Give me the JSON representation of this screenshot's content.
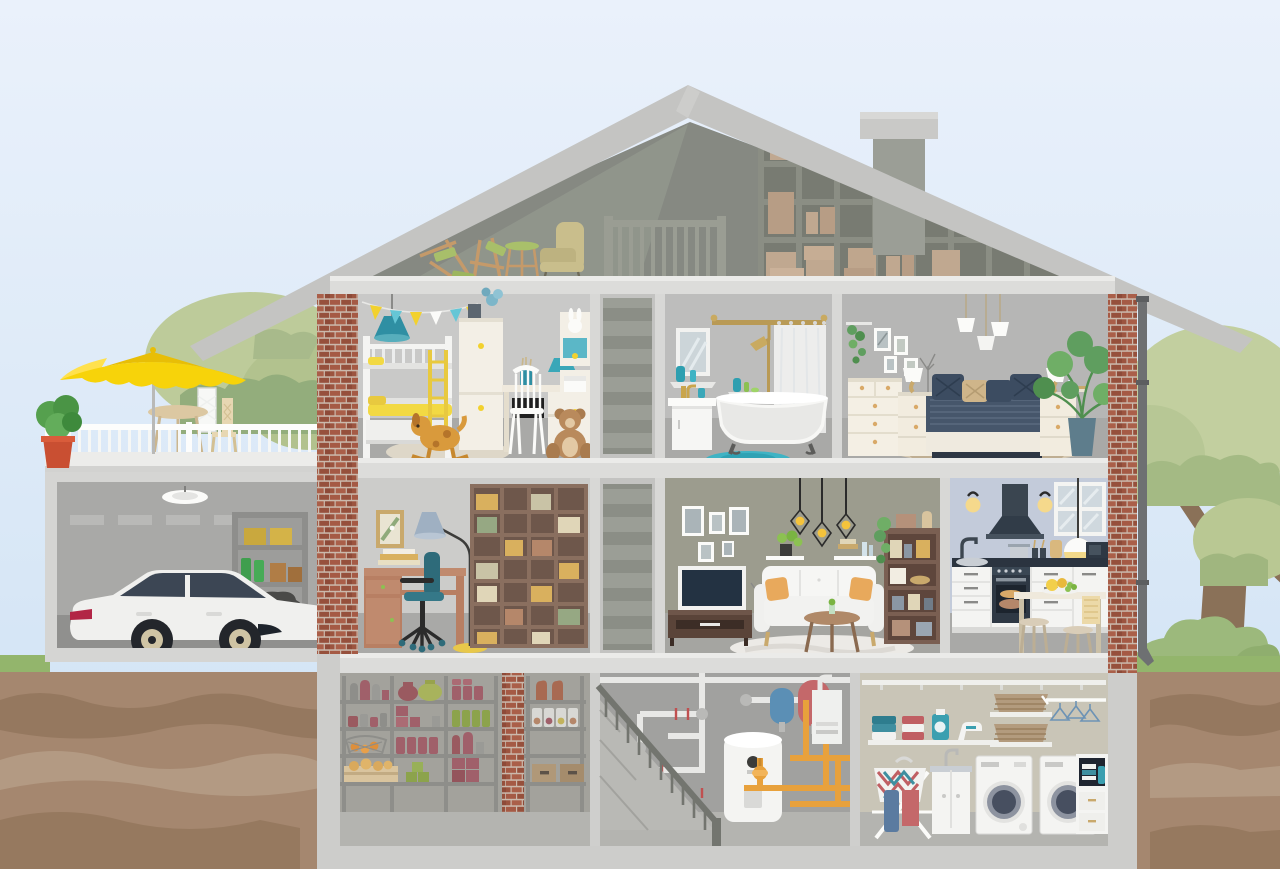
{
  "scene": {
    "label": "Cutaway cross-section illustration of a two-storey family house with attic, basement, garage and roof terrace",
    "type": "flat vector illustration",
    "visible_text": "none"
  },
  "palette": {
    "sky_top": "#eaf1fb",
    "sky_bottom": "#cfe2f4",
    "roof": "#c4c4c2",
    "attic_wall": "#868982",
    "brick": "#a55a45",
    "mortar": "#cbb9ac",
    "slab": "#dcdcda",
    "room_divider": "#d8d8d6",
    "room_floor": "#a9a9a7",
    "basement_floor": "#b3b3af",
    "soil": "#a5876f",
    "soil_dark": "#95785f",
    "soil_light": "#b39a83",
    "grass": "#93b56c",
    "tree_light": "#c0cd9e",
    "tree_dark": "#9fb681",
    "trunk": "#8a7158",
    "umbrella_yellow": "#f7d30a",
    "accent_teal": "#3b9fb0",
    "accent_yellow": "#f2d43c",
    "bed_navy": "#46566b",
    "pipe_orange": "#e8a13c",
    "wood_brown": "#7a5f52",
    "car_body": "#f0f0ee",
    "tank_red": "#c4686a",
    "tank_blue": "#5b8fb5"
  },
  "outdoor": {
    "terrace": {
      "label": "Roof terrace over garage",
      "objects": [
        "yellow-parasol",
        "bistro-table",
        "garden-chair",
        "potted-shrub",
        "white-railing"
      ]
    },
    "garage": {
      "label": "Garage",
      "objects": [
        "white-estate-car",
        "ceiling-lamp",
        "storage-shelf",
        "yellow-boxes",
        "green-canisters",
        "tyre-stack"
      ]
    },
    "yard": {
      "label": "Yard and ground cross-section",
      "objects": [
        "tree-left",
        "tree-right",
        "bushes",
        "lawn-strip",
        "soil-layers",
        "rain-downspout"
      ]
    }
  },
  "house": {
    "attic": {
      "label": "Attic",
      "objects": [
        "cube-storage-shelf",
        "cardboard-boxes",
        "stair-railing",
        "old-armchair",
        "stacked-chairs",
        "stool",
        "chimney"
      ]
    },
    "second_floor": {
      "kids_room": {
        "label": "Kids room",
        "objects": [
          "bunk-bed",
          "yellow-bedding",
          "bunting-garland",
          "teal-pendant-lamp",
          "wardrobe",
          "desk",
          "white-chair",
          "teddy-bear",
          "rocking-dog-toy",
          "round-rug",
          "shelf-unit"
        ]
      },
      "staircase": {
        "label": "Staircase to attic"
      },
      "bathroom": {
        "label": "Bathroom",
        "objects": [
          "wall-mirror",
          "washbasin-cabinet",
          "clawfoot-bathtub",
          "shower-curtain",
          "brass-shower-set",
          "teal-rug",
          "cosmetic-bottles"
        ]
      },
      "bedroom": {
        "label": "Bedroom",
        "objects": [
          "double-bed",
          "navy-bedding",
          "nightstands",
          "table-lamps",
          "chest-of-drawers",
          "pendant-lamp-trio",
          "monstera-plant",
          "picture-frames",
          "patterned-rug"
        ]
      }
    },
    "first_floor": {
      "study": {
        "label": "Study",
        "objects": [
          "writing-desk",
          "teal-office-chair",
          "arc-floor-lamp",
          "large-bookcase",
          "wall-picture"
        ]
      },
      "staircase": {
        "label": "Staircase to second floor"
      },
      "living_room": {
        "label": "Living room",
        "objects": [
          "wall-tv",
          "tv-stand",
          "white-sofa",
          "orange-cushions",
          "round-coffee-table",
          "cage-pendant-lamps",
          "wall-shelves",
          "display-bookshelf",
          "picture-wall",
          "light-rug"
        ]
      },
      "kitchen": {
        "label": "Kitchen",
        "objects": [
          "cooker-hood",
          "oven",
          "sink",
          "dark-countertop",
          "glass-wall-cabinet",
          "microwave",
          "globe-pendant-lamp",
          "wall-sconces",
          "dining-table",
          "stools",
          "fruit-plate",
          "tea-towel"
        ]
      }
    },
    "basement": {
      "pantry": {
        "label": "Pantry cellar",
        "objects": [
          "metal-shelving",
          "preserve-jars",
          "bottles",
          "fruit-basket",
          "bread-crate",
          "storage-boxes",
          "brick-pillar"
        ]
      },
      "boiler_room": {
        "label": "Boiler room",
        "objects": [
          "basement-stairs",
          "water-heater-tank",
          "blue-expansion-tank",
          "red-expansion-tank",
          "wall-boiler",
          "white-pipes",
          "orange-pipes",
          "valves"
        ]
      },
      "laundry_room": {
        "label": "Laundry room",
        "objects": [
          "washing-machine-left",
          "washing-machine-right",
          "sink-cabinet",
          "drying-rack",
          "laundry-basket",
          "towel-shelf",
          "detergent-bottle",
          "iron",
          "wicker-baskets",
          "clothes-hangers",
          "supply-cabinet"
        ]
      }
    }
  }
}
